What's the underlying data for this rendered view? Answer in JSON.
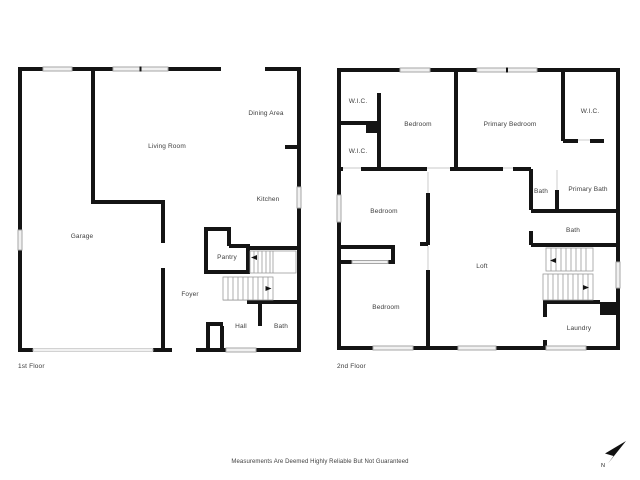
{
  "canvas": {
    "background": "#ffffff",
    "wall_color": "#141414",
    "window_color": "#f1f1f1",
    "label_color": "#3d3d3d"
  },
  "floors": [
    {
      "name": "1st Floor",
      "rooms": [
        {
          "label": "Dining Area"
        },
        {
          "label": "Living Room"
        },
        {
          "label": "Kitchen"
        },
        {
          "label": "Garage"
        },
        {
          "label": "Pantry"
        },
        {
          "label": "Foyer"
        },
        {
          "label": "Hall"
        },
        {
          "label": "Bath"
        }
      ]
    },
    {
      "name": "2nd Floor",
      "rooms": [
        {
          "label": "W.I.C."
        },
        {
          "label": "Bedroom"
        },
        {
          "label": "Primary Bedroom"
        },
        {
          "label": "W.I.C."
        },
        {
          "label": "W.I.C."
        },
        {
          "label": "Bath"
        },
        {
          "label": "Primary Bath"
        },
        {
          "label": "Bedroom"
        },
        {
          "label": "Bath"
        },
        {
          "label": "Loft"
        },
        {
          "label": "Bedroom"
        },
        {
          "label": "Laundry"
        }
      ]
    }
  ],
  "footer": {
    "disclaimer": "Measurements Are Deemed Highly Reliable But Not Guaranteed"
  },
  "compass": {
    "label": "N"
  }
}
